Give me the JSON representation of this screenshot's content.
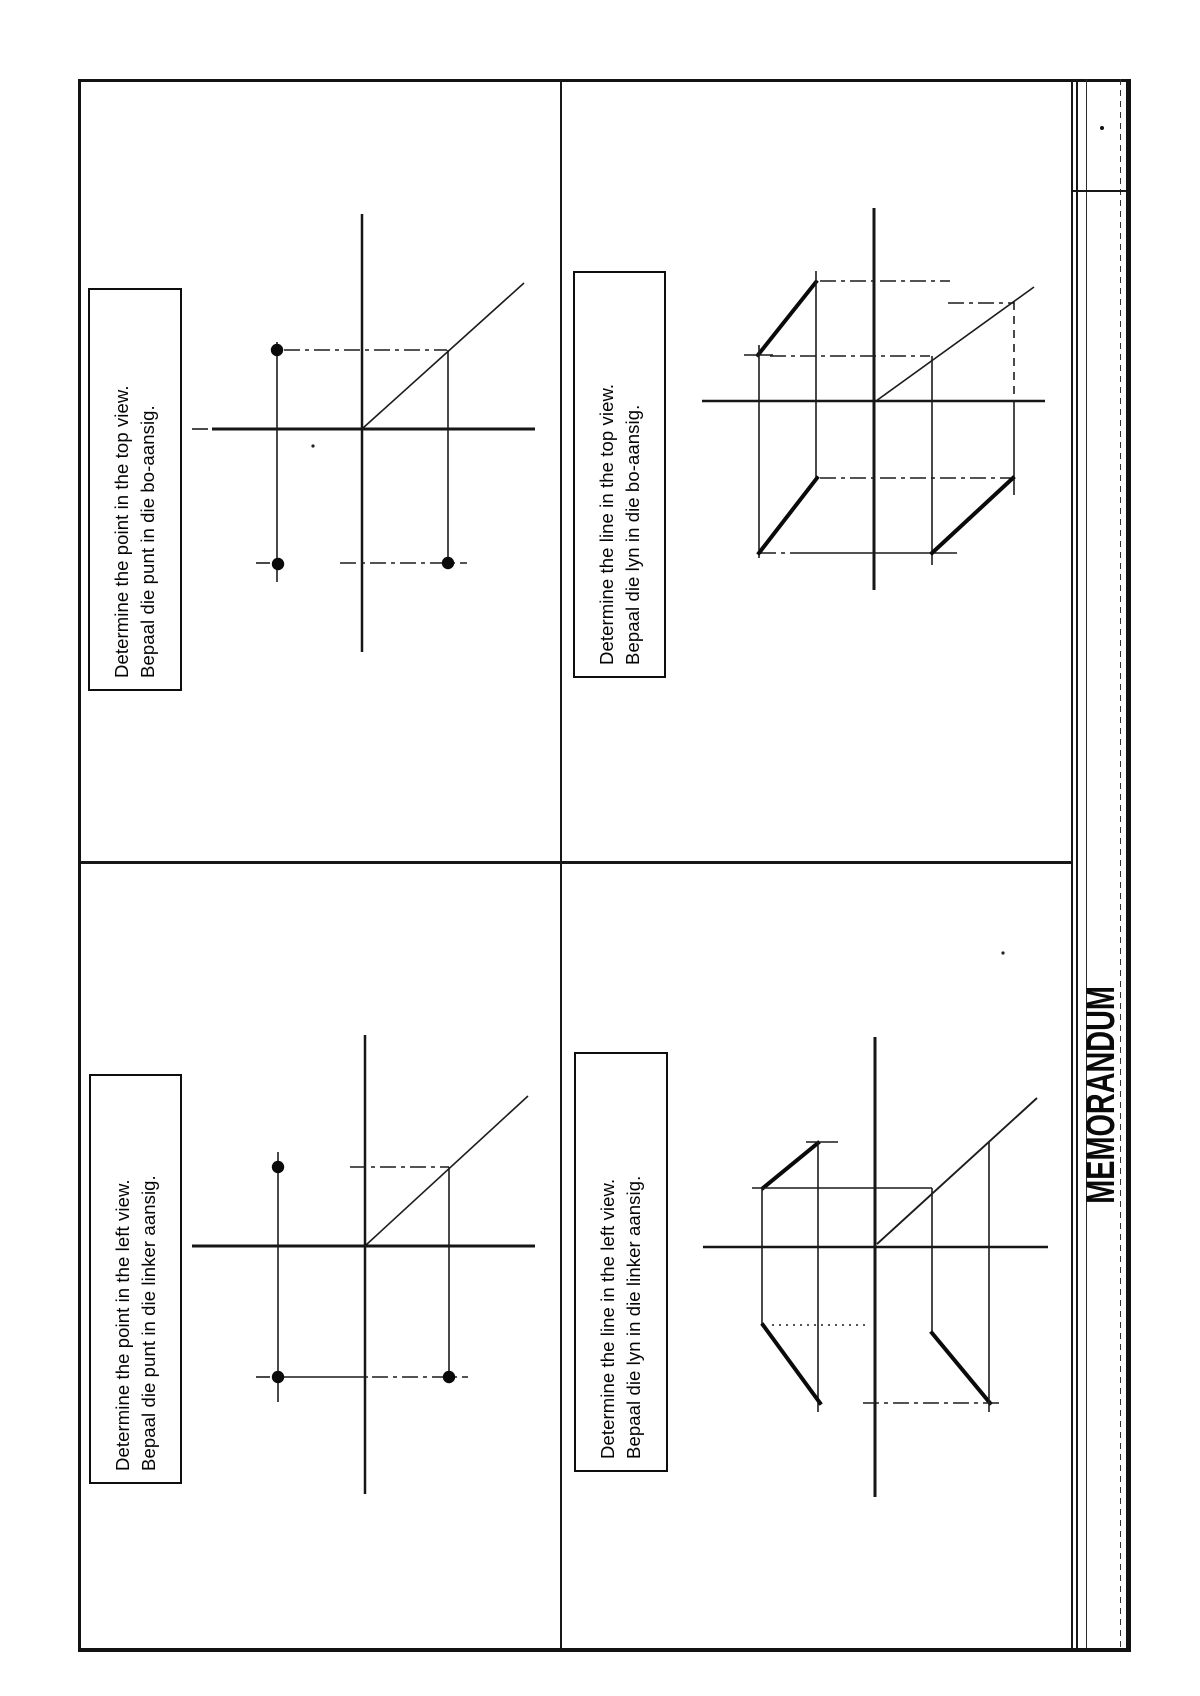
{
  "sidebar": {
    "label": "MEMORANDUM"
  },
  "quadrants": [
    {
      "name": "top-left",
      "instruction_en": "Determine the point in the top view.",
      "instruction_af": "Bepaal die punt in die bo-aansig."
    },
    {
      "name": "top-right",
      "instruction_en": "Determine the line in the top view.",
      "instruction_af": "Bepaal die lyn in die bo-aansig."
    },
    {
      "name": "bottom-left",
      "instruction_en": "Determine the point in the left view.",
      "instruction_af": "Bepaal die punt in die linker aansig."
    },
    {
      "name": "bottom-right",
      "instruction_en": "Determine the line in the left view.",
      "instruction_af": "Bepaal die lyn in die linker aansig."
    }
  ],
  "colors": {
    "ink": "#131313",
    "paper": "#ffffff"
  }
}
